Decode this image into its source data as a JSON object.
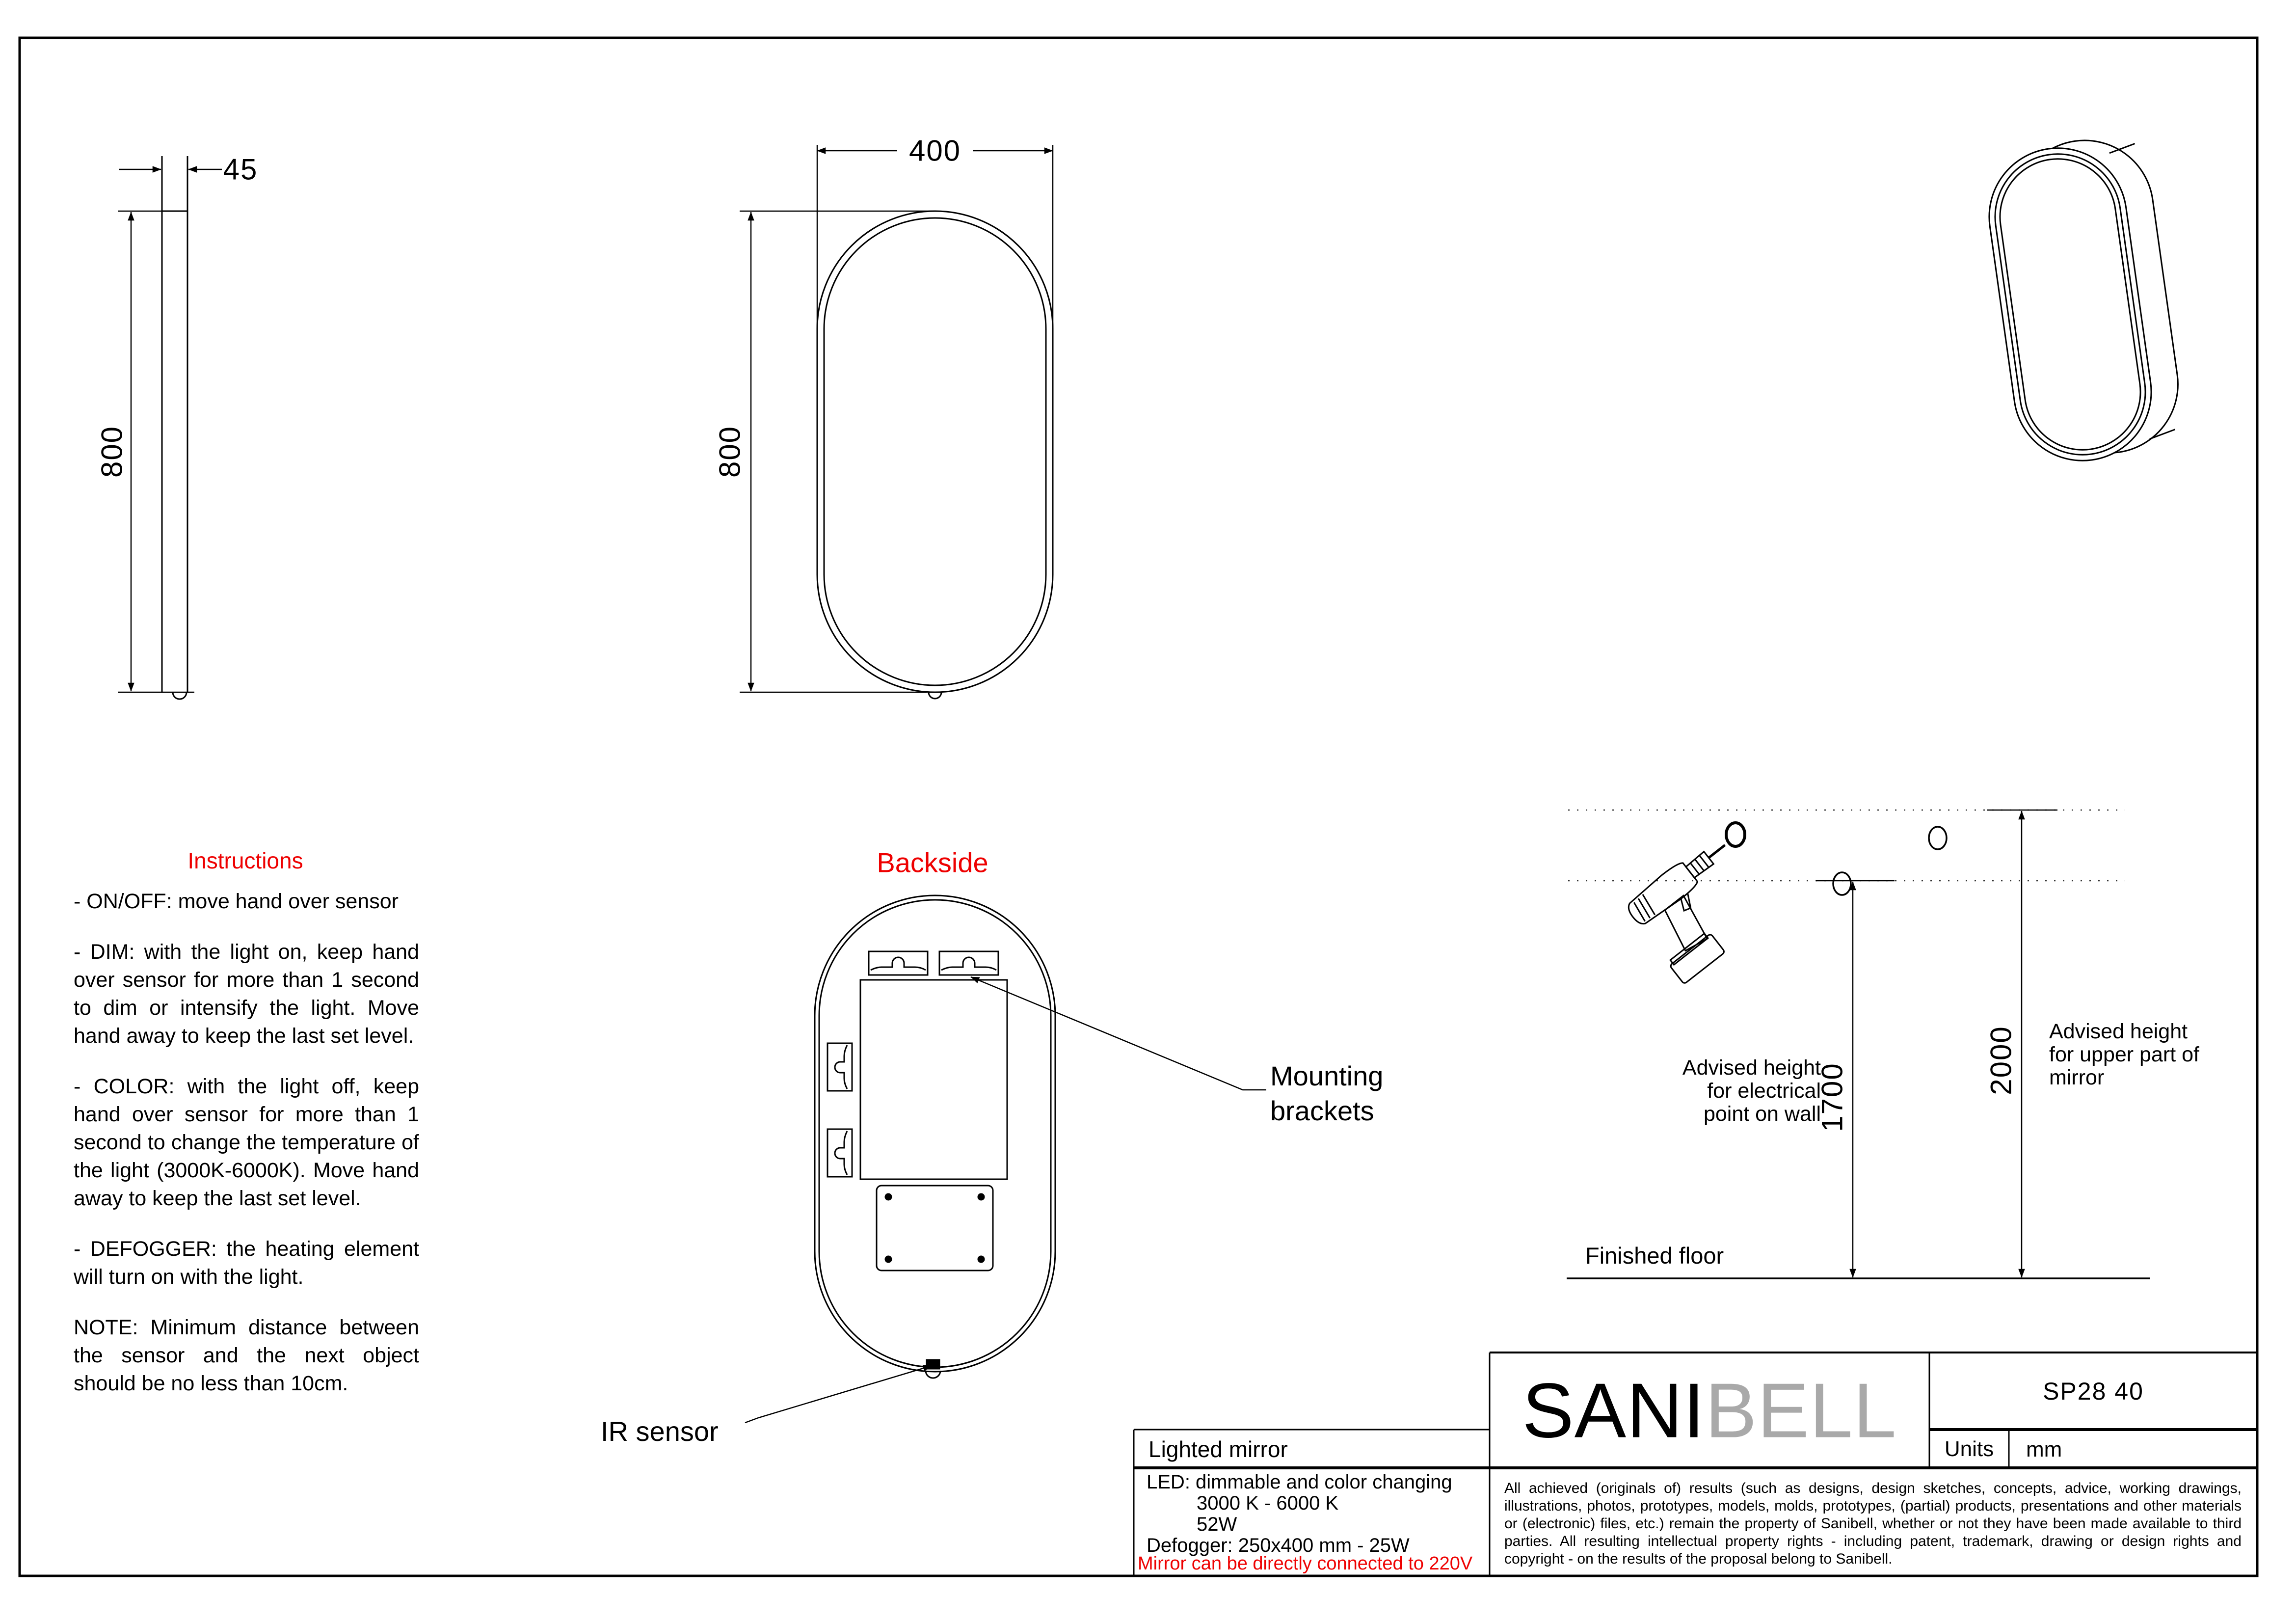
{
  "side_view": {
    "width_dim": "45",
    "height_dim": "800"
  },
  "front_view": {
    "width_dim": "400",
    "height_dim": "800"
  },
  "instructions": {
    "title": "Instructions",
    "items": [
      "- ON/OFF: move hand over sensor",
      "- DIM: with the light on, keep hand over sensor for more than 1 second to dim or intensify the light. Move hand away to keep the last set level.",
      "- COLOR: with the light off, keep hand over sensor for more than 1 second to change the temperature of the light (3000K-6000K). Move hand away to keep the last set level.",
      "- DEFOGGER: the heating element will turn on with the light.",
      "NOTE: Minimum distance between the sensor and the next object should be no less than 10cm."
    ]
  },
  "backside": {
    "title": "Backside",
    "mounting_label": "Mounting brackets",
    "ir_label": "IR sensor"
  },
  "installation": {
    "electrical_height_dim": "1700",
    "mirror_height_dim": "2000",
    "electrical_label": "Advised height for electrical point on wall",
    "mirror_label": "Advised height for upper part of mirror",
    "floor_label": "Finished floor"
  },
  "title_block": {
    "product": "Lighted mirror",
    "brand_primary": "SANI",
    "brand_secondary": "BELL",
    "model": "SP28 40",
    "units_label": "Units",
    "units_value": "mm",
    "specs": [
      "LED: dimmable and color changing",
      "3000 K - 6000 K",
      "52W",
      "Defogger: 250x400 mm - 25W"
    ],
    "warning": "Mirror can be directly connected to 220V",
    "legal": "All achieved (originals of) results (such as designs, design sketches, concepts, advice, working drawings, illustrations, photos, prototypes, models, molds, prototypes, (partial) products, presentations and other materials or (electronic) files, etc.) remain the property of Sanibell, whether or not they have been made available to third parties. All resulting intellectual property rights - including patent, trademark, drawing or design rights and copyright - on the results of the proposal belong to Sanibell."
  },
  "colors": {
    "accent_red": "#ee0000",
    "brand_gray": "#a9a9a9",
    "line": "#000000"
  }
}
